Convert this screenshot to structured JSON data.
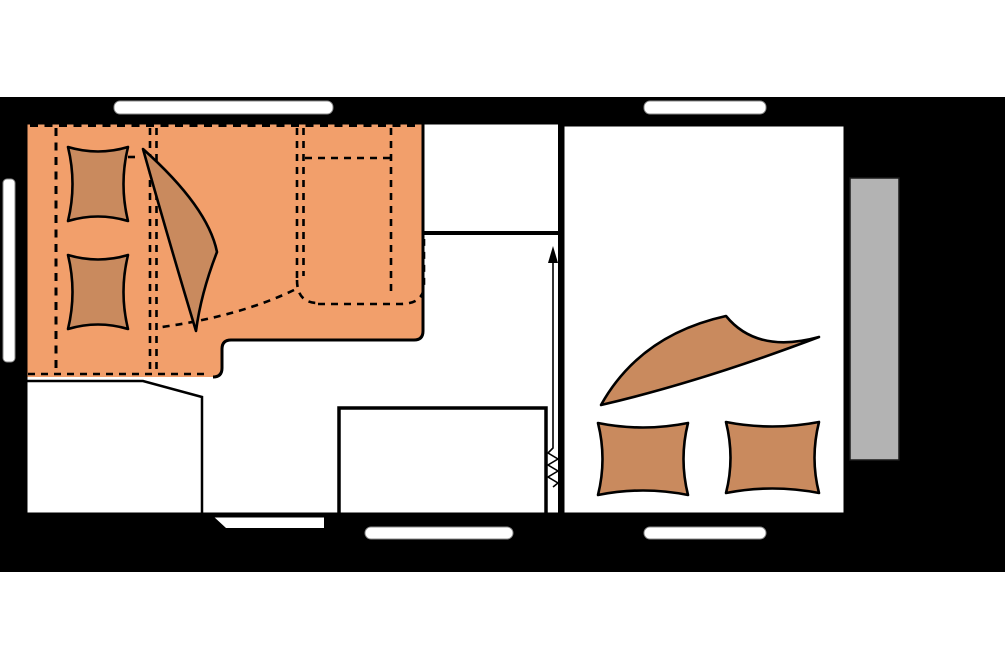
{
  "figure": {
    "label": "caravan-floor-plan-night-layout",
    "view": "top-down"
  },
  "colors": {
    "canvas_white": "#ffffff",
    "caravan_body_black": "#000000",
    "floor_white": "#ffffff",
    "window_white": "#ffffff",
    "window_border_gray": "#8a8a8a",
    "bed_area_orange": "#F29F6B",
    "bedding_dark_orange": "#C98A5E",
    "rear_bumper_gray": "#B3B3B3",
    "line_black": "#000000"
  },
  "icons": {
    "pillow": "pincushion-rectangle",
    "folded_blanket": "curved-triangle-corner",
    "bed_outline": "dashed-rectangle",
    "slide_direction": "up-arrow",
    "spring_mechanism": "vertical-zigzag",
    "window": "rounded-white-bar",
    "entry_step": "slanted-white-step",
    "rear_bumper": "gray-rectangle"
  },
  "rooms": {
    "front_bed_area": "front-lengthwise-double-bed",
    "kitchen_area": "front-kitchen-counter",
    "living_area": "dinette-with-table",
    "wardrobe": "corner-wardrobe",
    "rear_bed_room": "rear-transverse-bed"
  },
  "counts": {
    "pillows_front": 2,
    "pillows_rear": 2,
    "windows_top": 2,
    "windows_bottom": 2,
    "windows_front": 1
  }
}
